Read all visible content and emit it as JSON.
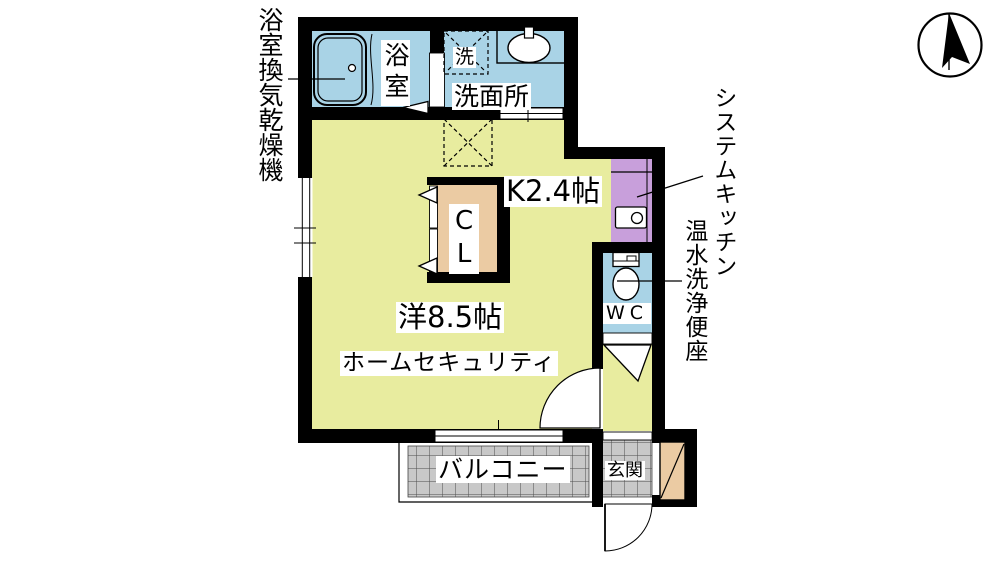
{
  "type": "apartment-floorplan",
  "compass": {
    "icon": "north-arrow"
  },
  "annotations": {
    "bath_vent": "浴室換気乾燥機",
    "system_kitchen": "システムキッチン",
    "washlet": "温水洗浄便座"
  },
  "rooms": {
    "bathroom": "浴室",
    "washer_space": "洗",
    "washroom": "洗面所",
    "kitchen": "K2.4帖",
    "closet": "CL",
    "wc": "WC",
    "main_room": "洋8.5帖",
    "security_note": "ホームセキュリティ",
    "balcony": "バルコニー",
    "entrance": "玄関"
  },
  "colors": {
    "floor": "#E8EC9F",
    "wet_area": "#A9D3E6",
    "kitchen_unit": "#C89FDB",
    "closet_tan": "#EBCBA3",
    "balcony_gray": "#C8C8C8",
    "wall": "#000000"
  }
}
